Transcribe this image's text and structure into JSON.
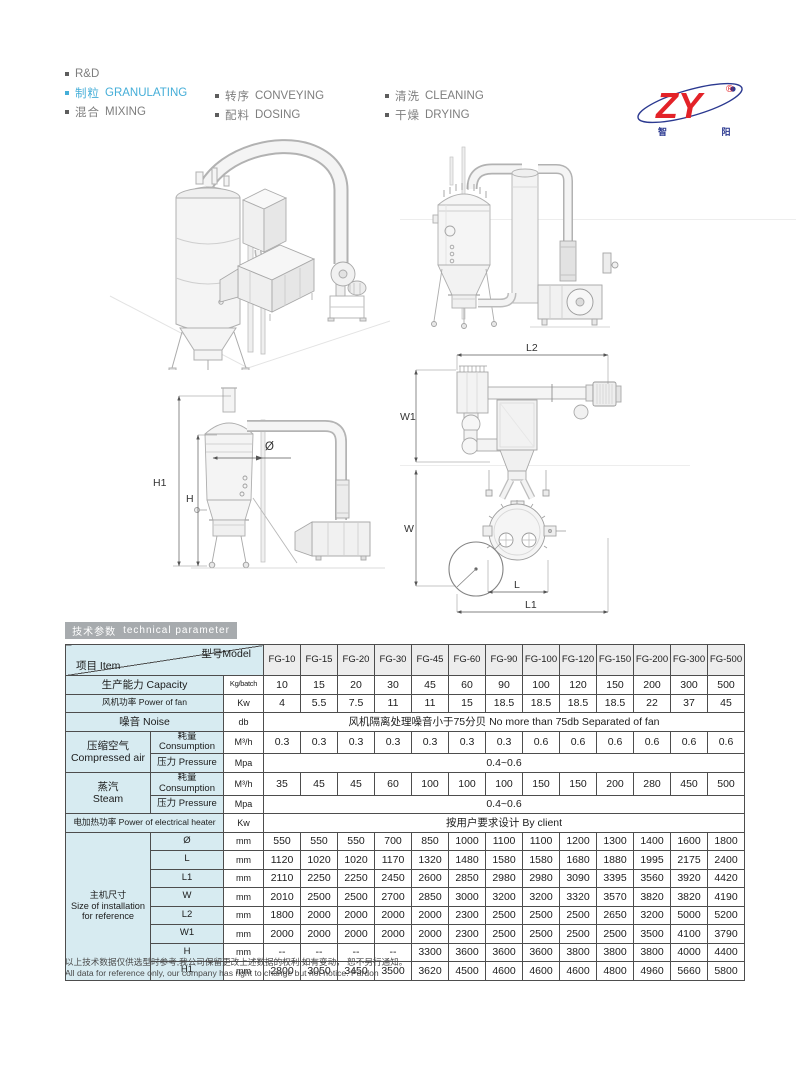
{
  "menu": {
    "items": [
      {
        "cn": "",
        "en": "R&D",
        "active": false
      },
      {
        "cn": "制粒",
        "en": "GRANULATING",
        "active": true
      },
      {
        "cn": "混合",
        "en": "MIXING",
        "active": false
      },
      {
        "cn": "转序",
        "en": "CONVEYING",
        "active": false
      },
      {
        "cn": "配料",
        "en": "DOSING",
        "active": false
      },
      {
        "cn": "清洗",
        "en": "CLEANING",
        "active": false
      },
      {
        "cn": "干燥",
        "en": "DRYING",
        "active": false
      }
    ]
  },
  "logo": {
    "text": "ZY",
    "reg": "®",
    "cn": "智  阳"
  },
  "banner": {
    "cn": "技术参数",
    "en": "technical parameter"
  },
  "diagrams": {
    "side": {
      "h1": "H1",
      "h": "H",
      "dia": "Ø"
    },
    "plan": {
      "l2": "L2",
      "w1": "W1",
      "w": "W",
      "l": "L",
      "l1": "L1"
    }
  },
  "table": {
    "corner": {
      "item": "项目 Item",
      "model": "型号Model"
    },
    "models": [
      "FG-10",
      "FG-15",
      "FG-20",
      "FG-30",
      "FG-45",
      "FG-60",
      "FG-90",
      "FG-100",
      "FG-120",
      "FG-150",
      "FG-200",
      "FG-300",
      "FG-500"
    ],
    "rows": [
      {
        "label": "生产能力 Capacity",
        "unit": "Kg/batch",
        "values": [
          "10",
          "15",
          "20",
          "30",
          "45",
          "60",
          "90",
          "100",
          "120",
          "150",
          "200",
          "300",
          "500"
        ]
      },
      {
        "label": "风机功率 Power of fan",
        "unit": "Kw",
        "values": [
          "4",
          "5.5",
          "7.5",
          "11",
          "11",
          "15",
          "18.5",
          "18.5",
          "18.5",
          "18.5",
          "22",
          "37",
          "45"
        ]
      },
      {
        "label": "噪音 Noise",
        "unit": "db",
        "span": "风机隔离处理噪音小于75分贝 No more than 75db Separated of fan"
      },
      {
        "group": {
          "lines": [
            "压缩空气",
            "Compressed air"
          ],
          "rowspan": 2
        },
        "sub": "耗量Consumption",
        "unit": "M³/h",
        "values": [
          "0.3",
          "0.3",
          "0.3",
          "0.3",
          "0.3",
          "0.3",
          "0.3",
          "0.6",
          "0.6",
          "0.6",
          "0.6",
          "0.6",
          "0.6"
        ]
      },
      {
        "sub": "压力 Pressure",
        "unit": "Mpa",
        "span": "0.4~0.6"
      },
      {
        "group": {
          "lines": [
            "蒸汽",
            "Steam"
          ],
          "rowspan": 2
        },
        "sub": "耗量Consumption",
        "unit": "M³/h",
        "values": [
          "35",
          "45",
          "45",
          "60",
          "100",
          "100",
          "100",
          "150",
          "150",
          "200",
          "280",
          "450",
          "500"
        ]
      },
      {
        "sub": "压力 Pressure",
        "unit": "Mpa",
        "span": "0.4~0.6"
      },
      {
        "label": "电加热功率 Power of electrical heater",
        "unit": "Kw",
        "span": "按用户要求设计 By client"
      },
      {
        "group": {
          "lines": [
            "主机尺寸",
            "Size of installation",
            "for reference"
          ],
          "rowspan": 8
        },
        "sub": "Ø",
        "unit": "mm",
        "values": [
          "550",
          "550",
          "550",
          "700",
          "850",
          "1000",
          "1100",
          "1100",
          "1200",
          "1300",
          "1400",
          "1600",
          "1800"
        ]
      },
      {
        "sub": "L",
        "unit": "mm",
        "values": [
          "1120",
          "1020",
          "1020",
          "1170",
          "1320",
          "1480",
          "1580",
          "1580",
          "1680",
          "1880",
          "1995",
          "2175",
          "2400"
        ]
      },
      {
        "sub": "L1",
        "unit": "mm",
        "values": [
          "2110",
          "2250",
          "2250",
          "2450",
          "2600",
          "2850",
          "2980",
          "2980",
          "3090",
          "3395",
          "3560",
          "3920",
          "4420"
        ]
      },
      {
        "sub": "W",
        "unit": "mm",
        "values": [
          "2010",
          "2500",
          "2500",
          "2700",
          "2850",
          "3000",
          "3200",
          "3200",
          "3320",
          "3570",
          "3820",
          "3820",
          "4190"
        ]
      },
      {
        "sub": "L2",
        "unit": "mm",
        "values": [
          "1800",
          "2000",
          "2000",
          "2000",
          "2000",
          "2300",
          "2500",
          "2500",
          "2500",
          "2650",
          "3200",
          "5000",
          "5200"
        ]
      },
      {
        "sub": "W1",
        "unit": "mm",
        "values": [
          "2000",
          "2000",
          "2000",
          "2000",
          "2000",
          "2300",
          "2500",
          "2500",
          "2500",
          "2500",
          "3500",
          "4100",
          "3790"
        ]
      },
      {
        "sub": "H",
        "unit": "mm",
        "values": [
          "--",
          "--",
          "--",
          "--",
          "3300",
          "3600",
          "3600",
          "3600",
          "3800",
          "3800",
          "3800",
          "4000",
          "4400"
        ]
      },
      {
        "sub": "H1",
        "unit": "mm",
        "values": [
          "2800",
          "3050",
          "3450",
          "3500",
          "3620",
          "4500",
          "4600",
          "4600",
          "4600",
          "4800",
          "4960",
          "5660",
          "5800"
        ]
      }
    ]
  },
  "footer": {
    "cn": "以上技术数据仅供选型时参考,我公司保留更改上述数据的权利,如有变动， 恕不另行通知。",
    "en": "All data for reference only, our company has right to change but not notice. Pardon"
  }
}
